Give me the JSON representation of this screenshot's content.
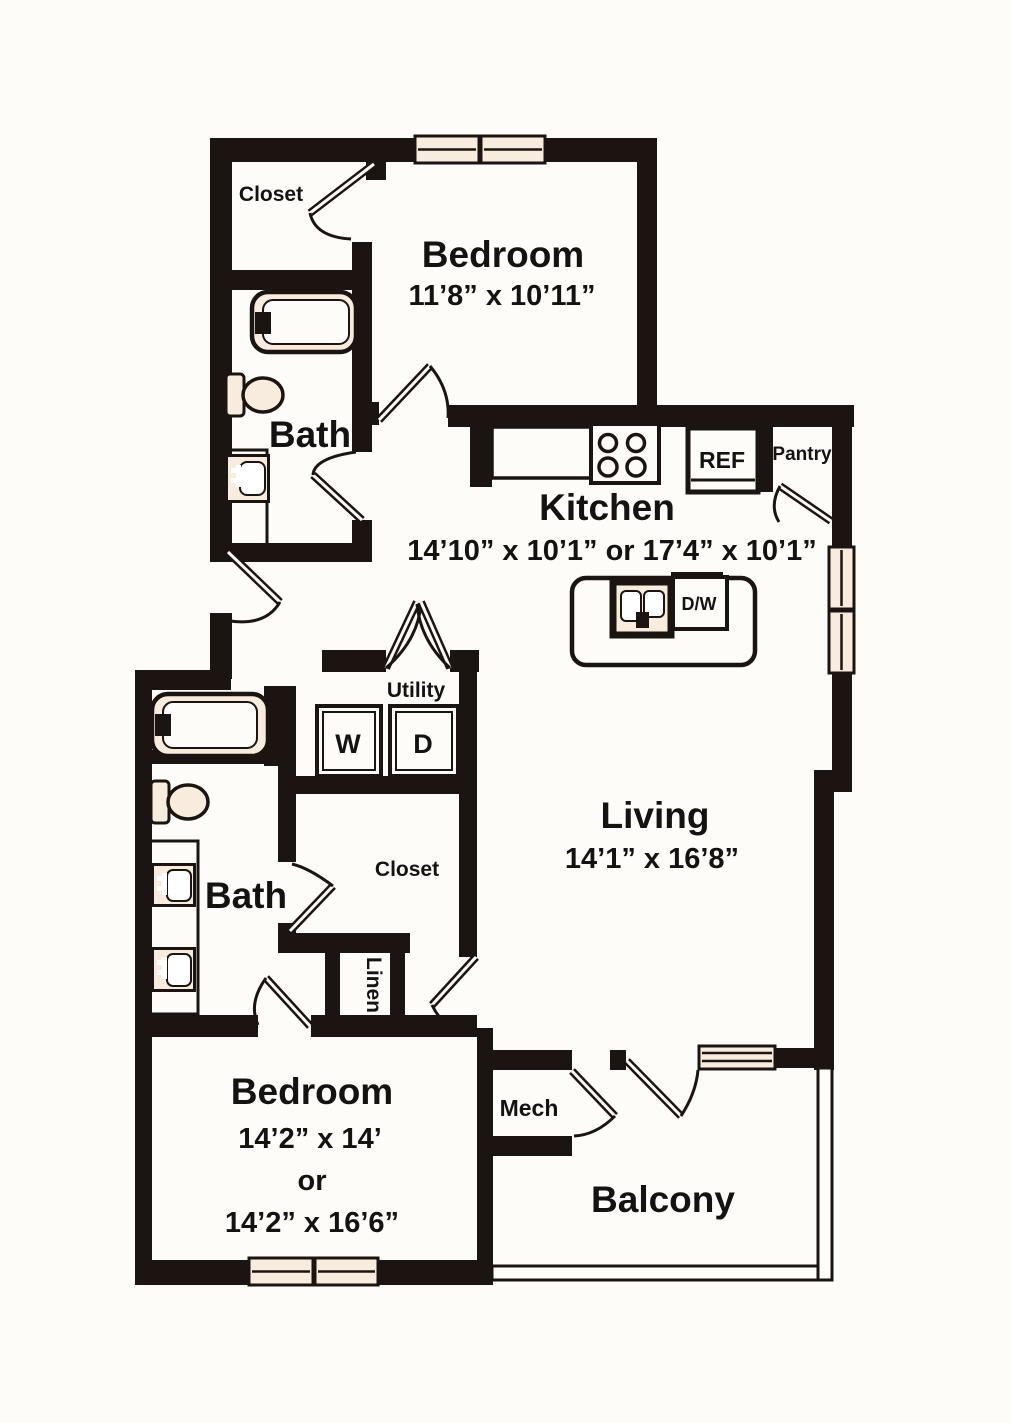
{
  "plan": {
    "rooms": {
      "bedroom_top": {
        "label": "Bedroom",
        "dims": "11’8” x 10’11”"
      },
      "kitchen": {
        "label": "Kitchen",
        "dims": "14’10” x 10’1” or 17’4” x 10’1”"
      },
      "living": {
        "label": "Living",
        "dims": "14’1” x 16’8”"
      },
      "bedroom_bottom": {
        "label": "Bedroom",
        "dims_primary": "14’2” x 14’",
        "conjunction": "or",
        "dims_alternate": "14’2” x 16’6”"
      },
      "bath_top": {
        "label": "Bath"
      },
      "bath_bottom": {
        "label": "Bath"
      },
      "closet_top": {
        "label": "Closet"
      },
      "closet_middle": {
        "label": "Closet"
      },
      "linen": {
        "label": "Linen"
      },
      "utility": {
        "label": "Utility"
      },
      "pantry": {
        "label": "Pantry"
      },
      "mech": {
        "label": "Mech"
      },
      "balcony": {
        "label": "Balcony"
      }
    },
    "appliances": {
      "refrigerator": "REF",
      "dishwasher": "D/W",
      "washer": "W",
      "dryer": "D"
    },
    "colors": {
      "wall": "#1c1410",
      "fixture_fill": "#f7ecdd",
      "background": "#fdfcf9",
      "text": "#151311"
    }
  }
}
